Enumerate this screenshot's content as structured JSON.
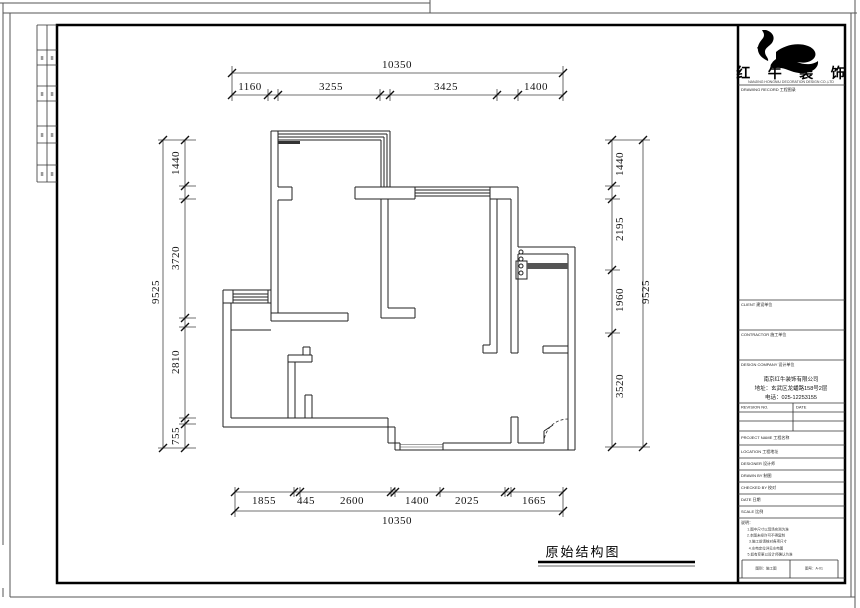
{
  "plan": {
    "title": "原始结构图"
  },
  "dims": {
    "top": {
      "total": "10350",
      "segs": [
        "1160",
        "3255",
        "3425",
        "1400"
      ]
    },
    "bottom": {
      "total": "10350",
      "segs": [
        "1855",
        "445",
        "2600",
        "1400",
        "2025",
        "1665"
      ]
    },
    "left": {
      "total": "9525",
      "segs": [
        "1440",
        "3720",
        "2810",
        "755"
      ]
    },
    "right": {
      "total": "9525",
      "segs": [
        "1440",
        "2195",
        "1960",
        "3520"
      ]
    }
  },
  "title_block": {
    "logo_text": "红 牛 装 饰",
    "logo_subtext": "NANJING HONGNIU DECORATION DESIGN CO.,LTD",
    "box2_label": "DRAWING RECORD 工程图录",
    "box3_label": "CLIENT 建设单位",
    "box4_label": "CONTRACTOR 施工单位",
    "company_label": "DESIGN COMPANY 设计单位",
    "company_lines": [
      "南京红牛装饰有限公司",
      "地址：玄武区龙蟠路158号2层",
      "电话：025-12253155"
    ],
    "rev_no_label": "REVISION NO.",
    "rev_date_label": "DATE",
    "rows": [
      {
        "label": "PROJECT NAME 工程名称"
      },
      {
        "label": "LOCATION 工程地址"
      },
      {
        "label": "DESIGNER 设计师"
      },
      {
        "label": "DRAWN BY 制图"
      },
      {
        "label": "CHECKED BY 校对"
      },
      {
        "label": "DATE 日期"
      },
      {
        "label": "SCALE 比例"
      }
    ],
    "notes_label": "说明：",
    "notes_lines": [
      "1.图中尺寸以现场实测为准",
      "2.本图未经许可不得复制",
      "3.施工前请核对各项尺寸",
      "4.水电定位详见水电图",
      "5.如有变更以设计师确认为准"
    ],
    "footer_left": "图别：施工图",
    "footer_right": "图号：A-01"
  },
  "frame": {
    "strip_rows": [
      {
        "c1": "≣",
        "c2": "≣"
      },
      {
        "c1": "≣",
        "c2": "≣"
      },
      {
        "c1": "≣",
        "c2": "≣"
      },
      {
        "c1": "≣",
        "c2": "≣"
      }
    ]
  }
}
